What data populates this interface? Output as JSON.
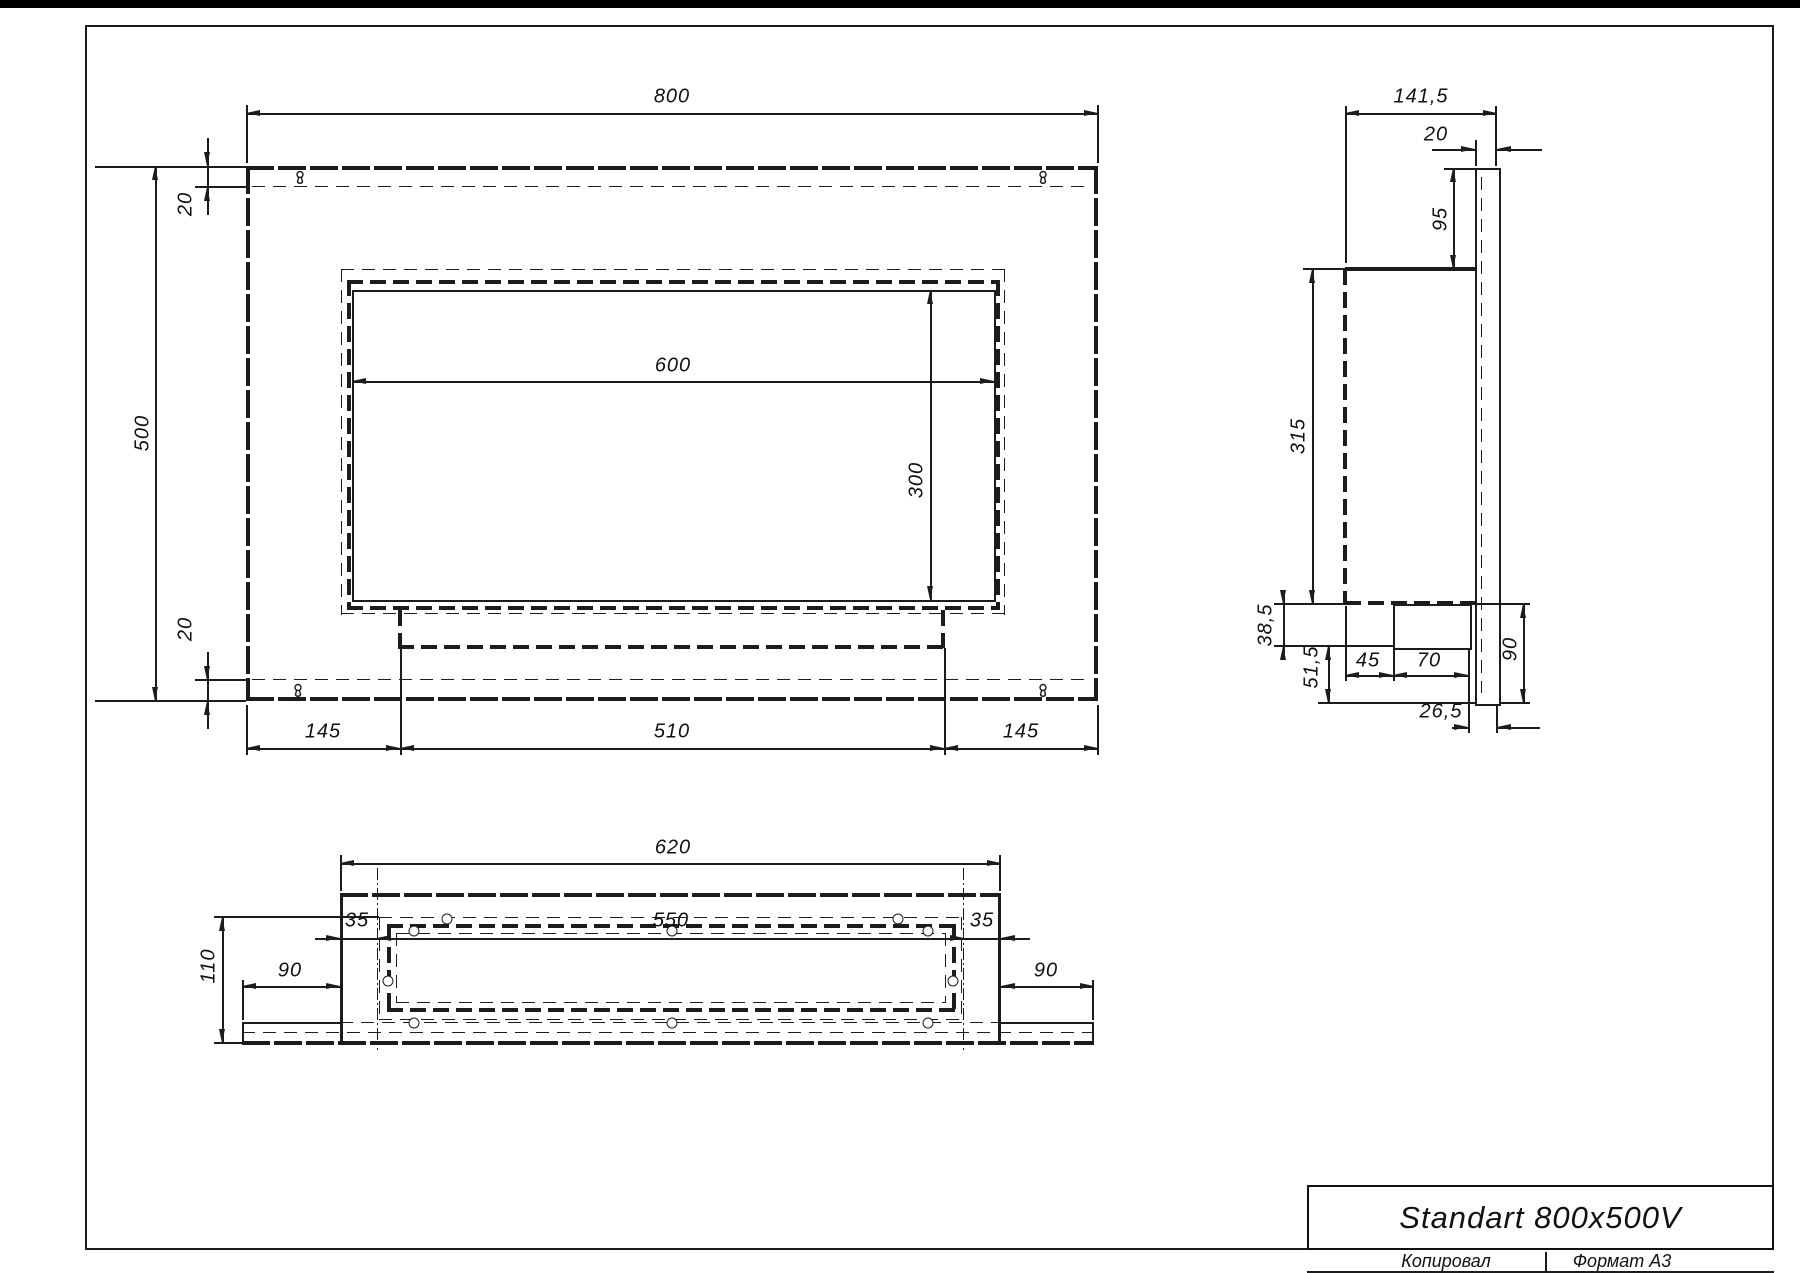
{
  "front_view": {
    "dims": {
      "width": "800",
      "height": "500",
      "flange_top": "20",
      "flange_bottom": "20",
      "opening_width": "600",
      "opening_height": "300",
      "margin_left": "145",
      "tray_width": "510",
      "margin_right": "145"
    }
  },
  "side_view": {
    "dims": {
      "depth": "141,5",
      "plate_thickness": "20",
      "plate_above_body": "95",
      "body_height": "315",
      "tray_below_body": "38,5",
      "below_tray": "51,5",
      "tray_offset": "45",
      "tray_depth": "70",
      "plate_below_body": "90",
      "rear_offset": "26,5"
    }
  },
  "bottom_view": {
    "dims": {
      "body_width": "620",
      "mount_span": "550",
      "margin_left": "35",
      "margin_right": "35",
      "total_height": "110",
      "plate_left": "90",
      "plate_right": "90"
    }
  },
  "title_block": {
    "title": "Standart 800x500V"
  },
  "footer": {
    "copied_by": "Копировал",
    "format": "Формат А3"
  }
}
